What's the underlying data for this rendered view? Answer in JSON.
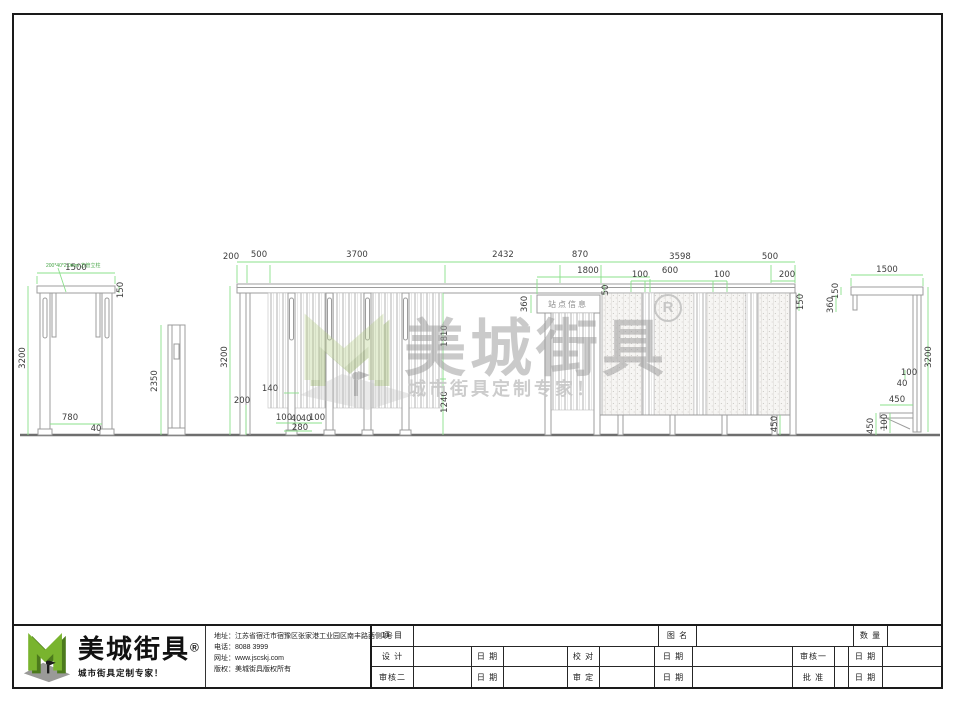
{
  "sheet": {
    "material_note": "200*40*2.0mm 方管立柱",
    "left_view": {
      "width": "1500",
      "cap_height": "150",
      "height": "3200",
      "inner_width": "780",
      "post_width": "40"
    },
    "post_view": {
      "height": "2350"
    },
    "main_view": {
      "row1": [
        "200",
        "500",
        "3700",
        "2432",
        "870",
        "3598",
        "500"
      ],
      "row2": [
        "1800",
        "100",
        "600",
        "100",
        "200"
      ],
      "height": "3200",
      "plinth": "200",
      "slot_width": "140",
      "bottom": [
        "100",
        "40",
        "40",
        "100",
        "280"
      ],
      "open_upper": "1810",
      "open_lower": "1240",
      "sign_height": "360",
      "sign_offset": "50",
      "roof_right": "150",
      "panel_foot": "450",
      "sign_label": "站点信息"
    },
    "side_view": {
      "width": "1500",
      "cap_height": "150",
      "drop": "360",
      "height": "3200",
      "seat_back": "100",
      "seat_gap": "40",
      "seat_depth": "450",
      "leg": "100",
      "seat_height": "450"
    }
  },
  "watermark": {
    "brand": "美城街具",
    "reg": "R",
    "slogan": "城市街具定制专家！"
  },
  "title_block": {
    "brand": "美城街具",
    "reg": "®",
    "slogan": "城市街具定制专家！",
    "info": [
      {
        "label": "地址：",
        "value": "江苏省宿迁市宿豫区张家港工业园区南丰路西侧1号"
      },
      {
        "label": "电话：",
        "value": "8088 3999"
      },
      {
        "label": "网址：",
        "value": "www.jscskj.com"
      },
      {
        "label": "版权：",
        "value": "美城街具版权所有"
      }
    ],
    "fields": {
      "project": "项 目",
      "drawing_name": "图 名",
      "quantity": "数 量",
      "design": "设 计",
      "date": "日 期",
      "check": "校 对",
      "review1": "审核一",
      "review2": "审核二",
      "approve": "审 定",
      "ratify": "批 准"
    }
  }
}
